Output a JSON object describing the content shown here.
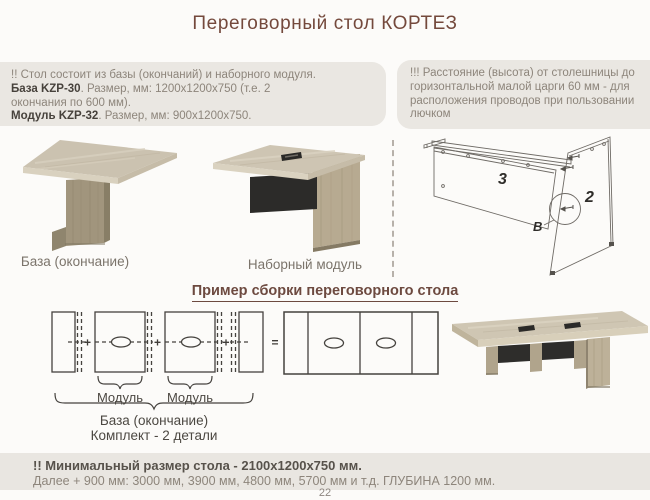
{
  "title": "Переговорный стол КОРТЕЗ",
  "info_left": {
    "line1": "!! Стол состоит из базы (окончаний) и наборного модуля.",
    "line2_bold": "База KZP-30",
    "line2_rest": ". Размер, мм: 1200х1200х750 (т.е. 2",
    "line3": "окончания по 600 мм).",
    "line4_bold": "Модуль KZP-32",
    "line4_rest": ". Размер, мм: 900х1200х750."
  },
  "info_right": {
    "text": "!!! Расстояние (высота) от столешницы до горизонтальной малой царги 60 мм - для расположения проводов при пользовании лючком"
  },
  "products": {
    "base_label": "База (окончание)",
    "module_label": "Наборный модуль"
  },
  "diagram": {
    "part3": "3",
    "part2": "2",
    "detail": "B"
  },
  "example": {
    "heading": "Пример сборки переговорного стола",
    "plus": "+",
    "equals": "=",
    "module_label_1": "Модуль",
    "module_label_2": "Модуль",
    "base_label": "База (окончание)",
    "kit_label": "Комплект - 2 детали"
  },
  "footer": {
    "line1": "!! Минимальный размер стола - 2100х1200х750 мм.",
    "line2": "Далее + 900 мм: 3000 мм, 3900 мм, 4800 мм, 5700 мм и т.д. ГЛУБИНА 1200 мм.",
    "page": "22"
  },
  "colors": {
    "accent_brown": "#74493c",
    "box_bg": "#eae7e2",
    "wood_top": "#cfc6b3",
    "dark_panel": "#2c2b29"
  }
}
